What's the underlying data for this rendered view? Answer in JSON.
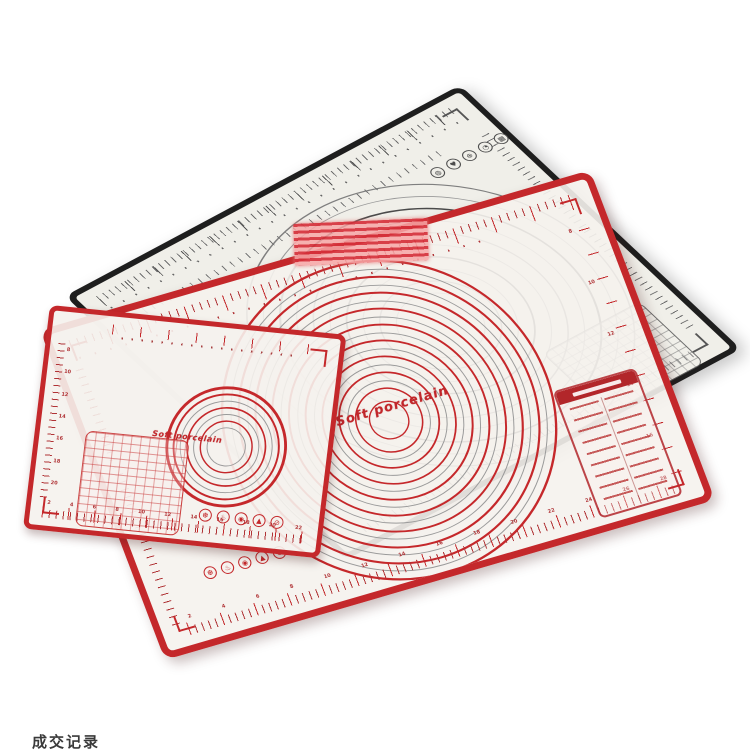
{
  "scene": {
    "description": "three translucent silicone pastry baking mats with measurement markings overlapping on white background",
    "caption": "成交记录"
  },
  "colors": {
    "red_border": "#c4282b",
    "dark_red": "#b2262a",
    "black_border": "#1e1e1e",
    "gray_print": "#8d8d8d",
    "mat_surface": "#f3f1ec"
  },
  "mats": {
    "black": {
      "icons": [
        "◍",
        "♥",
        "⊕",
        "◔",
        "▦"
      ]
    },
    "large_red": {
      "brand": "Soft porcelain",
      "bottom_ruler_numbers": [
        2,
        4,
        6,
        8,
        10,
        12,
        14,
        16,
        18,
        20,
        22,
        24,
        26,
        28
      ],
      "side_ruler_numbers": [
        8,
        10,
        12,
        14,
        16
      ],
      "icons": [
        "❆",
        "♨",
        "◉",
        "▲",
        "⊘"
      ]
    },
    "small_red": {
      "brand": "Soft porcelain",
      "bottom_ruler_numbers": [
        2,
        4,
        6,
        8,
        10,
        12,
        14,
        16,
        18,
        20,
        22
      ],
      "left_ruler_numbers": [
        8,
        10,
        12,
        14,
        16,
        18,
        20
      ],
      "icons": [
        "❆",
        "♨",
        "◉",
        "▲",
        "⊘"
      ]
    }
  }
}
